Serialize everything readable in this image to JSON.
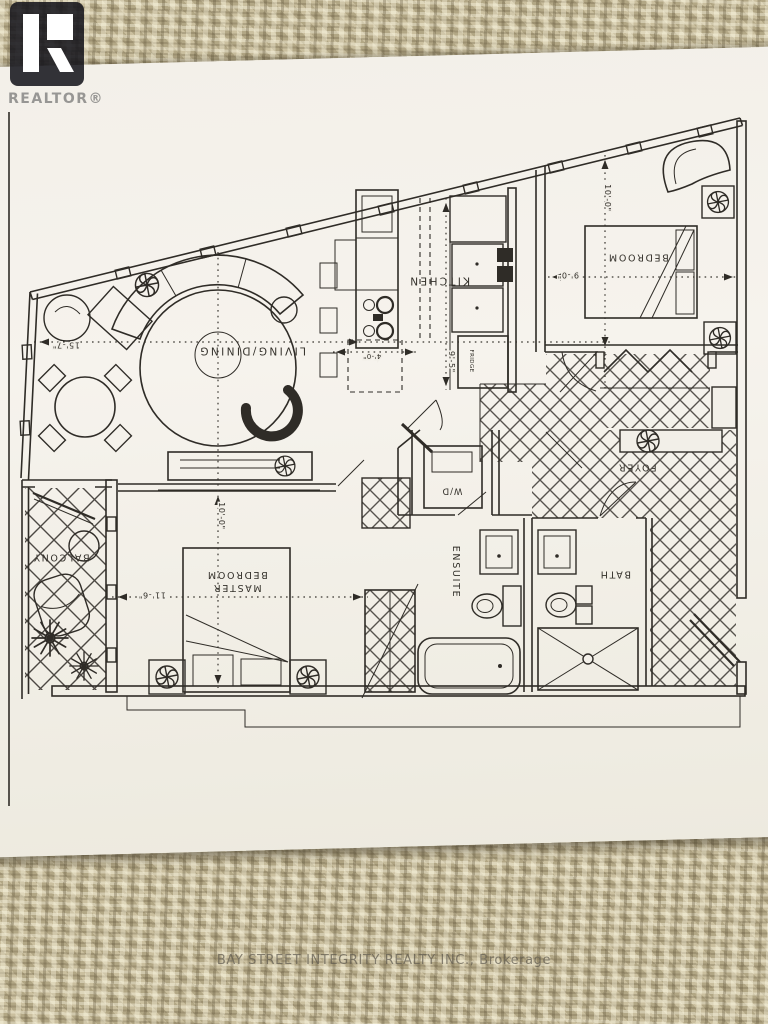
{
  "watermarks": {
    "realtor": "REALTOR®",
    "brokerage": "BAY STREET INTEGRITY REALTY INC., Brokerage"
  },
  "plan": {
    "labels": {
      "living_dining": "LIVING/DINING",
      "kitchen": "KITCHEN",
      "bedroom": "BEDROOM",
      "master_line1": "MASTER",
      "master_line2": "BEDROOM",
      "foyer": "FOYER",
      "balcony": "BALCONY",
      "ensuite": "ENSUITE",
      "bath": "BATH",
      "laundry": "W/D",
      "fridge": "FRIDGE"
    },
    "dimensions": {
      "living_width": "15'-7\"",
      "master_width": "11'-6\"",
      "master_depth": "10'-0\"",
      "bedroom_width": "9'-0\"",
      "bedroom_depth": "10'-0\"",
      "kitchen_depth": "9'-5\"",
      "island_width": "4'-0\""
    }
  }
}
